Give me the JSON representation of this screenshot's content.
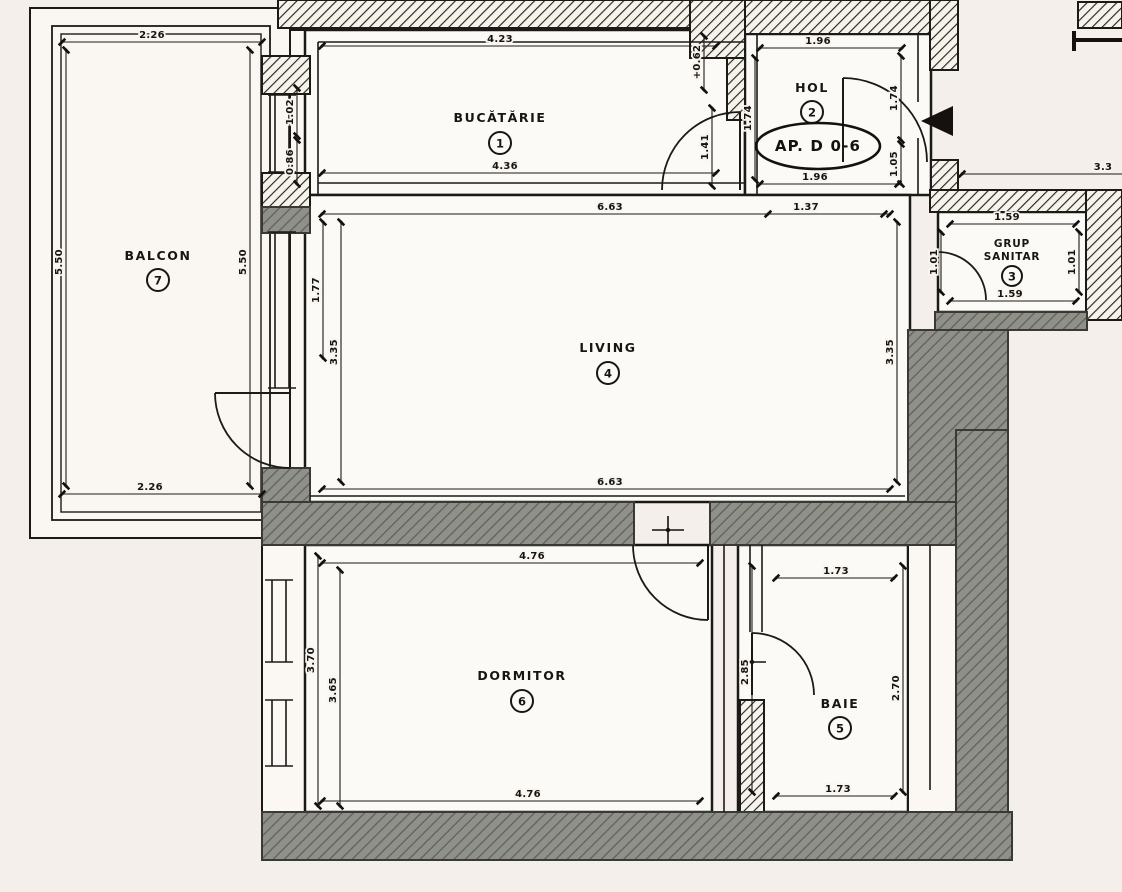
{
  "plan": {
    "apartment_label": "AP. D 0-6",
    "rooms": {
      "bucatarie": {
        "name": "BUCĂTĂRIE",
        "number": "1"
      },
      "hol": {
        "name": "HOL",
        "number": "2"
      },
      "grup_sanitar": {
        "line1": "GRUP",
        "line2": "SANITAR",
        "number": "3"
      },
      "living": {
        "name": "LIVING",
        "number": "4"
      },
      "baie": {
        "name": "BAIE",
        "number": "5"
      },
      "dormitor": {
        "name": "DORMITOR",
        "number": "6"
      },
      "balcon": {
        "name": "BALCON",
        "number": "7"
      }
    },
    "dims": {
      "balcon_top": "2.26",
      "balcon_bottom": "2.26",
      "balcon_left": "5.50",
      "balcon_right": "5.50",
      "bucatarie_top": "4.23",
      "bucatarie_bottom": "4.36",
      "wall_left_upper": "1.02",
      "wall_left_lower": "0.86",
      "hol_top": "1.96",
      "hol_bottom": "1.96",
      "hol_entry": "1.37",
      "hol_left": "1.74",
      "hol_right_upper": "1.74",
      "hol_right_lower": "1.05",
      "kitchen_door_height": "1.41",
      "kitchen_door_level": "+0.62",
      "grup_top": "1.59",
      "grup_bottom": "1.59",
      "grup_left": "1.01",
      "grup_right": "1.01",
      "living_top": "6.63",
      "living_bottom": "6.63",
      "living_left_inner": "1.77",
      "living_left": "3.35",
      "living_right": "3.35",
      "dormitor_top": "4.76",
      "dormitor_bottom": "4.76",
      "dormitor_left": "3.70",
      "dormitor_left_inner": "3.65",
      "baie_top": "1.73",
      "baie_bottom": "1.73",
      "baie_left": "2.85",
      "baie_right": "2.70",
      "ext_right": "3.3"
    }
  }
}
